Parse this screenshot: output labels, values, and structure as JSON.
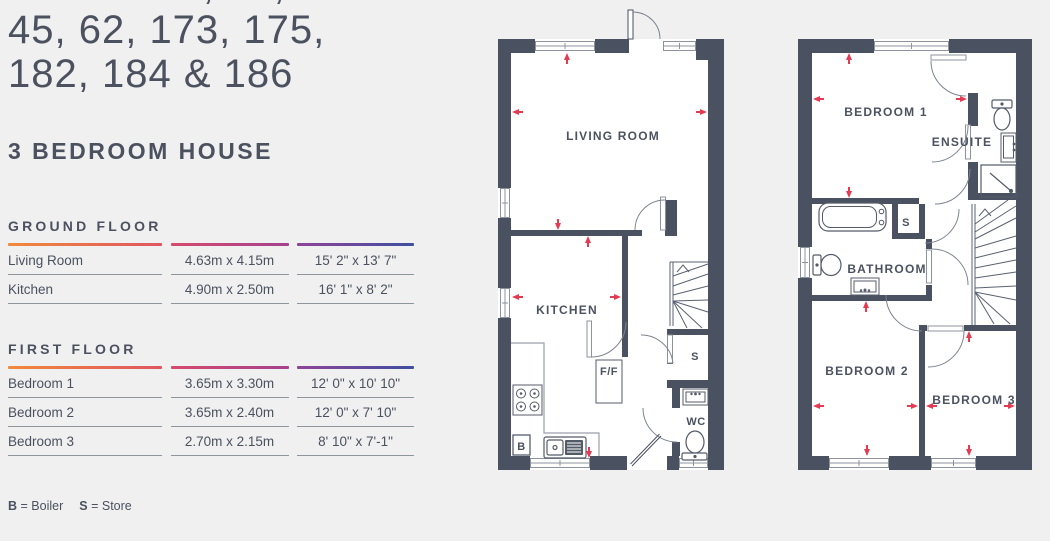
{
  "title": {
    "line1": "PLOTS 34, 36,",
    "line2": "45, 62, 173, 175,",
    "line3": "182, 184 & 186",
    "subtitle": "3 BEDROOM HOUSE"
  },
  "tables": {
    "ground": {
      "heading": "GROUND FLOOR",
      "rows": [
        {
          "name": "Living Room",
          "metric": "4.63m x 4.15m",
          "imperial": "15' 2\" x 13' 7\""
        },
        {
          "name": "Kitchen",
          "metric": "4.90m x 2.50m",
          "imperial": "16' 1\" x 8' 2\""
        }
      ]
    },
    "first": {
      "heading": "FIRST FLOOR",
      "rows": [
        {
          "name": "Bedroom 1",
          "metric": "3.65m x 3.30m",
          "imperial": "12' 0\" x 10' 10\""
        },
        {
          "name": "Bedroom 2",
          "metric": "3.65m x 2.40m",
          "imperial": "12' 0\" x 7' 10\""
        },
        {
          "name": "Bedroom 3",
          "metric": "2.70m x 2.15m",
          "imperial": "8' 10\" x 7'-1\""
        }
      ]
    }
  },
  "legend": {
    "items": [
      {
        "key": "B",
        "text": "= Boiler"
      },
      {
        "key": "S",
        "text": "= Store"
      }
    ]
  },
  "plans": {
    "ground": {
      "labels": {
        "living": "LIVING ROOM",
        "kitchen": "KITCHEN",
        "ff": "F/F",
        "store": "S",
        "wc": "WC",
        "boiler": "B"
      }
    },
    "first": {
      "labels": {
        "bed1": "BEDROOM 1",
        "ensuite": "ENSUITE",
        "store": "S",
        "bathroom": "BATHROOM",
        "bed2": "BEDROOM 2",
        "bed3": "BEDROOM 3"
      }
    }
  },
  "colors": {
    "background": "#f0f0f1",
    "wall": "#4a5160",
    "text": "#4b515e",
    "accent_red": "#e63a52",
    "line_gray": "#8e959d",
    "gradient": [
      "#f08a3c",
      "#e05560",
      "#d64a6e",
      "#a4418e",
      "#8e4399",
      "#3f4f9f"
    ]
  }
}
